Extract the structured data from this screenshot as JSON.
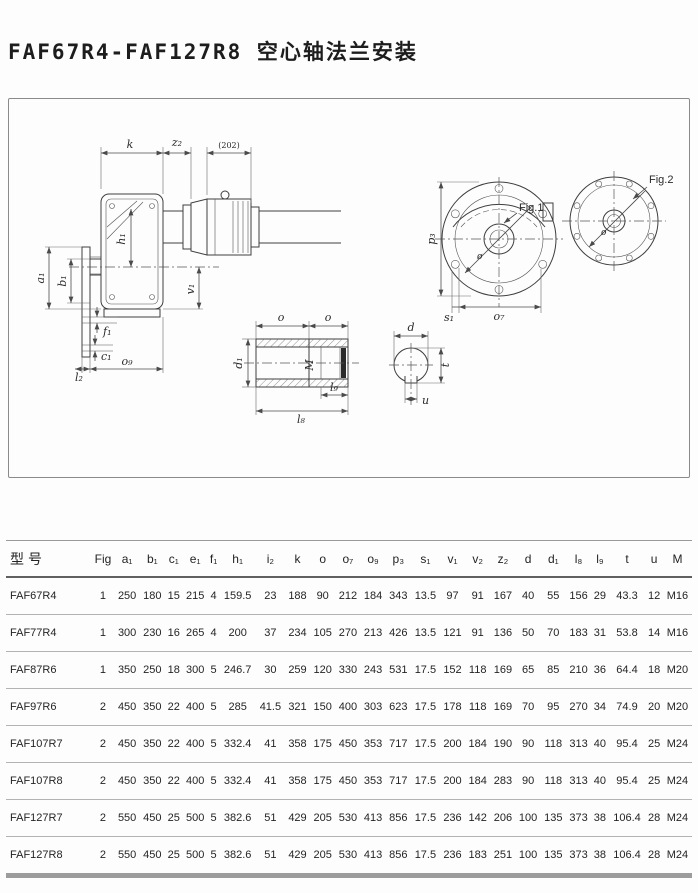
{
  "page": {
    "title": "FAF67R4-FAF127R8 空心轴法兰安装"
  },
  "colors": {
    "line": "#3e3e3e",
    "dim_line": "#4a4a4a",
    "table_rule": "#b3b3b3",
    "header_rule": "#606060",
    "bottom_bar": "#9c9c9c",
    "text": "#2b2b2b"
  },
  "drawing": {
    "labels": {
      "k": "k",
      "z2": "z₂",
      "dia202": "(202)",
      "a1": "a₁",
      "b1": "b₁",
      "h1": "h₁",
      "v1": "v₁",
      "f1": "f₁",
      "c1": "c₁",
      "l2": "l₂",
      "o9": "o₉",
      "o_left": "o",
      "o_right": "o",
      "d1": "d₁",
      "M": "M",
      "l9": "l₉",
      "l8": "l₈",
      "d": "d",
      "t": "t",
      "u": "u",
      "p3": "p₃",
      "s1": "s₁",
      "o7": "o₇",
      "fig1": "Fig.1",
      "fig2": "Fig.2",
      "dia_mark1": "ø",
      "dia_mark2": "ø"
    }
  },
  "table": {
    "columns": [
      "型号",
      "Fig",
      "a₁",
      "b₁",
      "c₁",
      "e₁",
      "f₁",
      "h₁",
      "i₂",
      "k",
      "o",
      "o₇",
      "o₉",
      "p₃",
      "s₁",
      "v₁",
      "v₂",
      "z₂",
      "d",
      "d₁",
      "l₈",
      "l₉",
      "t",
      "u",
      "M"
    ],
    "rows": [
      [
        "FAF67R4",
        "1",
        "250",
        "180",
        "15",
        "215",
        "4",
        "159.5",
        "23",
        "188",
        "90",
        "212",
        "184",
        "343",
        "13.5",
        "97",
        "91",
        "167",
        "40",
        "55",
        "156",
        "29",
        "43.3",
        "12",
        "M16"
      ],
      [
        "FAF77R4",
        "1",
        "300",
        "230",
        "16",
        "265",
        "4",
        "200",
        "37",
        "234",
        "105",
        "270",
        "213",
        "426",
        "13.5",
        "121",
        "91",
        "136",
        "50",
        "70",
        "183",
        "31",
        "53.8",
        "14",
        "M16"
      ],
      [
        "FAF87R6",
        "1",
        "350",
        "250",
        "18",
        "300",
        "5",
        "246.7",
        "30",
        "259",
        "120",
        "330",
        "243",
        "531",
        "17.5",
        "152",
        "118",
        "169",
        "65",
        "85",
        "210",
        "36",
        "64.4",
        "18",
        "M20"
      ],
      [
        "FAF97R6",
        "2",
        "450",
        "350",
        "22",
        "400",
        "5",
        "285",
        "41.5",
        "321",
        "150",
        "400",
        "303",
        "623",
        "17.5",
        "178",
        "118",
        "169",
        "70",
        "95",
        "270",
        "34",
        "74.9",
        "20",
        "M20"
      ],
      [
        "FAF107R7",
        "2",
        "450",
        "350",
        "22",
        "400",
        "5",
        "332.4",
        "41",
        "358",
        "175",
        "450",
        "353",
        "717",
        "17.5",
        "200",
        "184",
        "190",
        "90",
        "118",
        "313",
        "40",
        "95.4",
        "25",
        "M24"
      ],
      [
        "FAF107R8",
        "2",
        "450",
        "350",
        "22",
        "400",
        "5",
        "332.4",
        "41",
        "358",
        "175",
        "450",
        "353",
        "717",
        "17.5",
        "200",
        "184",
        "283",
        "90",
        "118",
        "313",
        "40",
        "95.4",
        "25",
        "M24"
      ],
      [
        "FAF127R7",
        "2",
        "550",
        "450",
        "25",
        "500",
        "5",
        "382.6",
        "51",
        "429",
        "205",
        "530",
        "413",
        "856",
        "17.5",
        "236",
        "142",
        "206",
        "100",
        "135",
        "373",
        "38",
        "106.4",
        "28",
        "M24"
      ],
      [
        "FAF127R8",
        "2",
        "550",
        "450",
        "25",
        "500",
        "5",
        "382.6",
        "51",
        "429",
        "205",
        "530",
        "413",
        "856",
        "17.5",
        "236",
        "183",
        "251",
        "100",
        "135",
        "373",
        "38",
        "106.4",
        "28",
        "M24"
      ]
    ]
  }
}
